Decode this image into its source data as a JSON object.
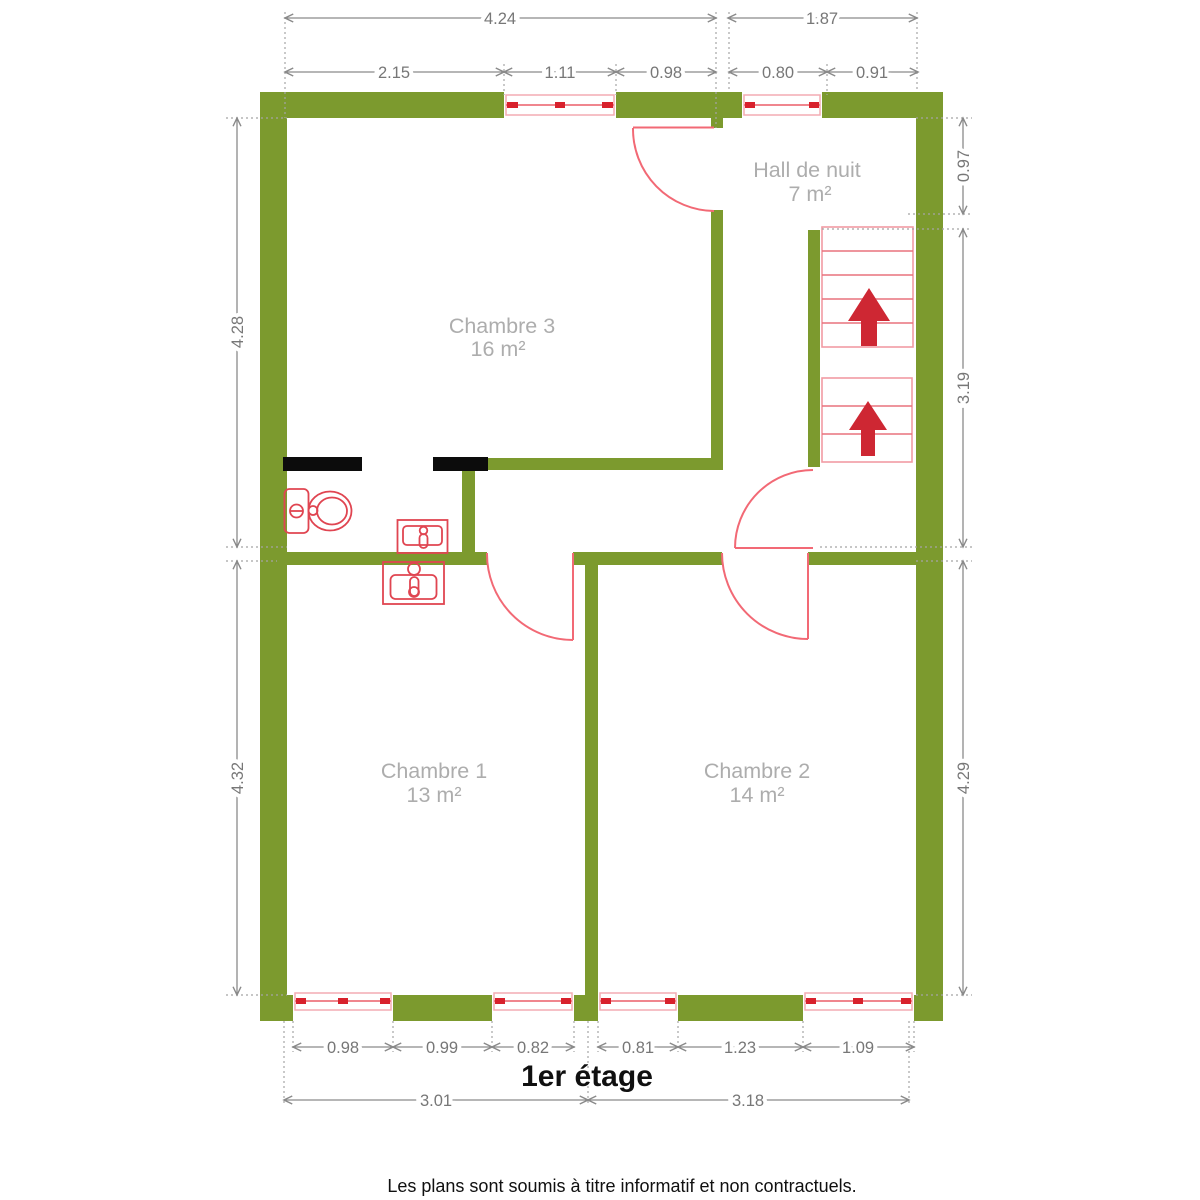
{
  "page": {
    "title": "1er étage",
    "disclaimer": "Les plans sont soumis à titre informatif et non contractuels."
  },
  "rooms": [
    {
      "name": "Chambre 3",
      "area": "16 m²"
    },
    {
      "name": "Hall de nuit",
      "area": "7 m²"
    },
    {
      "name": "Chambre 1",
      "area": "13 m²"
    },
    {
      "name": "Chambre 2",
      "area": "14 m²"
    }
  ],
  "dimensions": {
    "top_overall": [
      "4.24",
      "1.87"
    ],
    "top_detail": [
      "2.15",
      "1.11",
      "0.98",
      "0.80",
      "0.91"
    ],
    "left": [
      "4.28",
      "4.32"
    ],
    "right": [
      "0.97",
      "3.19",
      "4.29"
    ],
    "bottom_detail": [
      "0.98",
      "0.99",
      "0.82",
      "0.81",
      "1.23",
      "1.09"
    ],
    "bottom_overall": [
      "3.01",
      "3.18"
    ]
  },
  "colors": {
    "wall_green": "#7c9a2e",
    "fixture_red": "#e04551",
    "accent_red": "#ce2733",
    "window_pink": "#f3acb3",
    "dimension_gray": "#8a8a8a",
    "label_gray": "#adadad",
    "text_black": "#101010"
  }
}
